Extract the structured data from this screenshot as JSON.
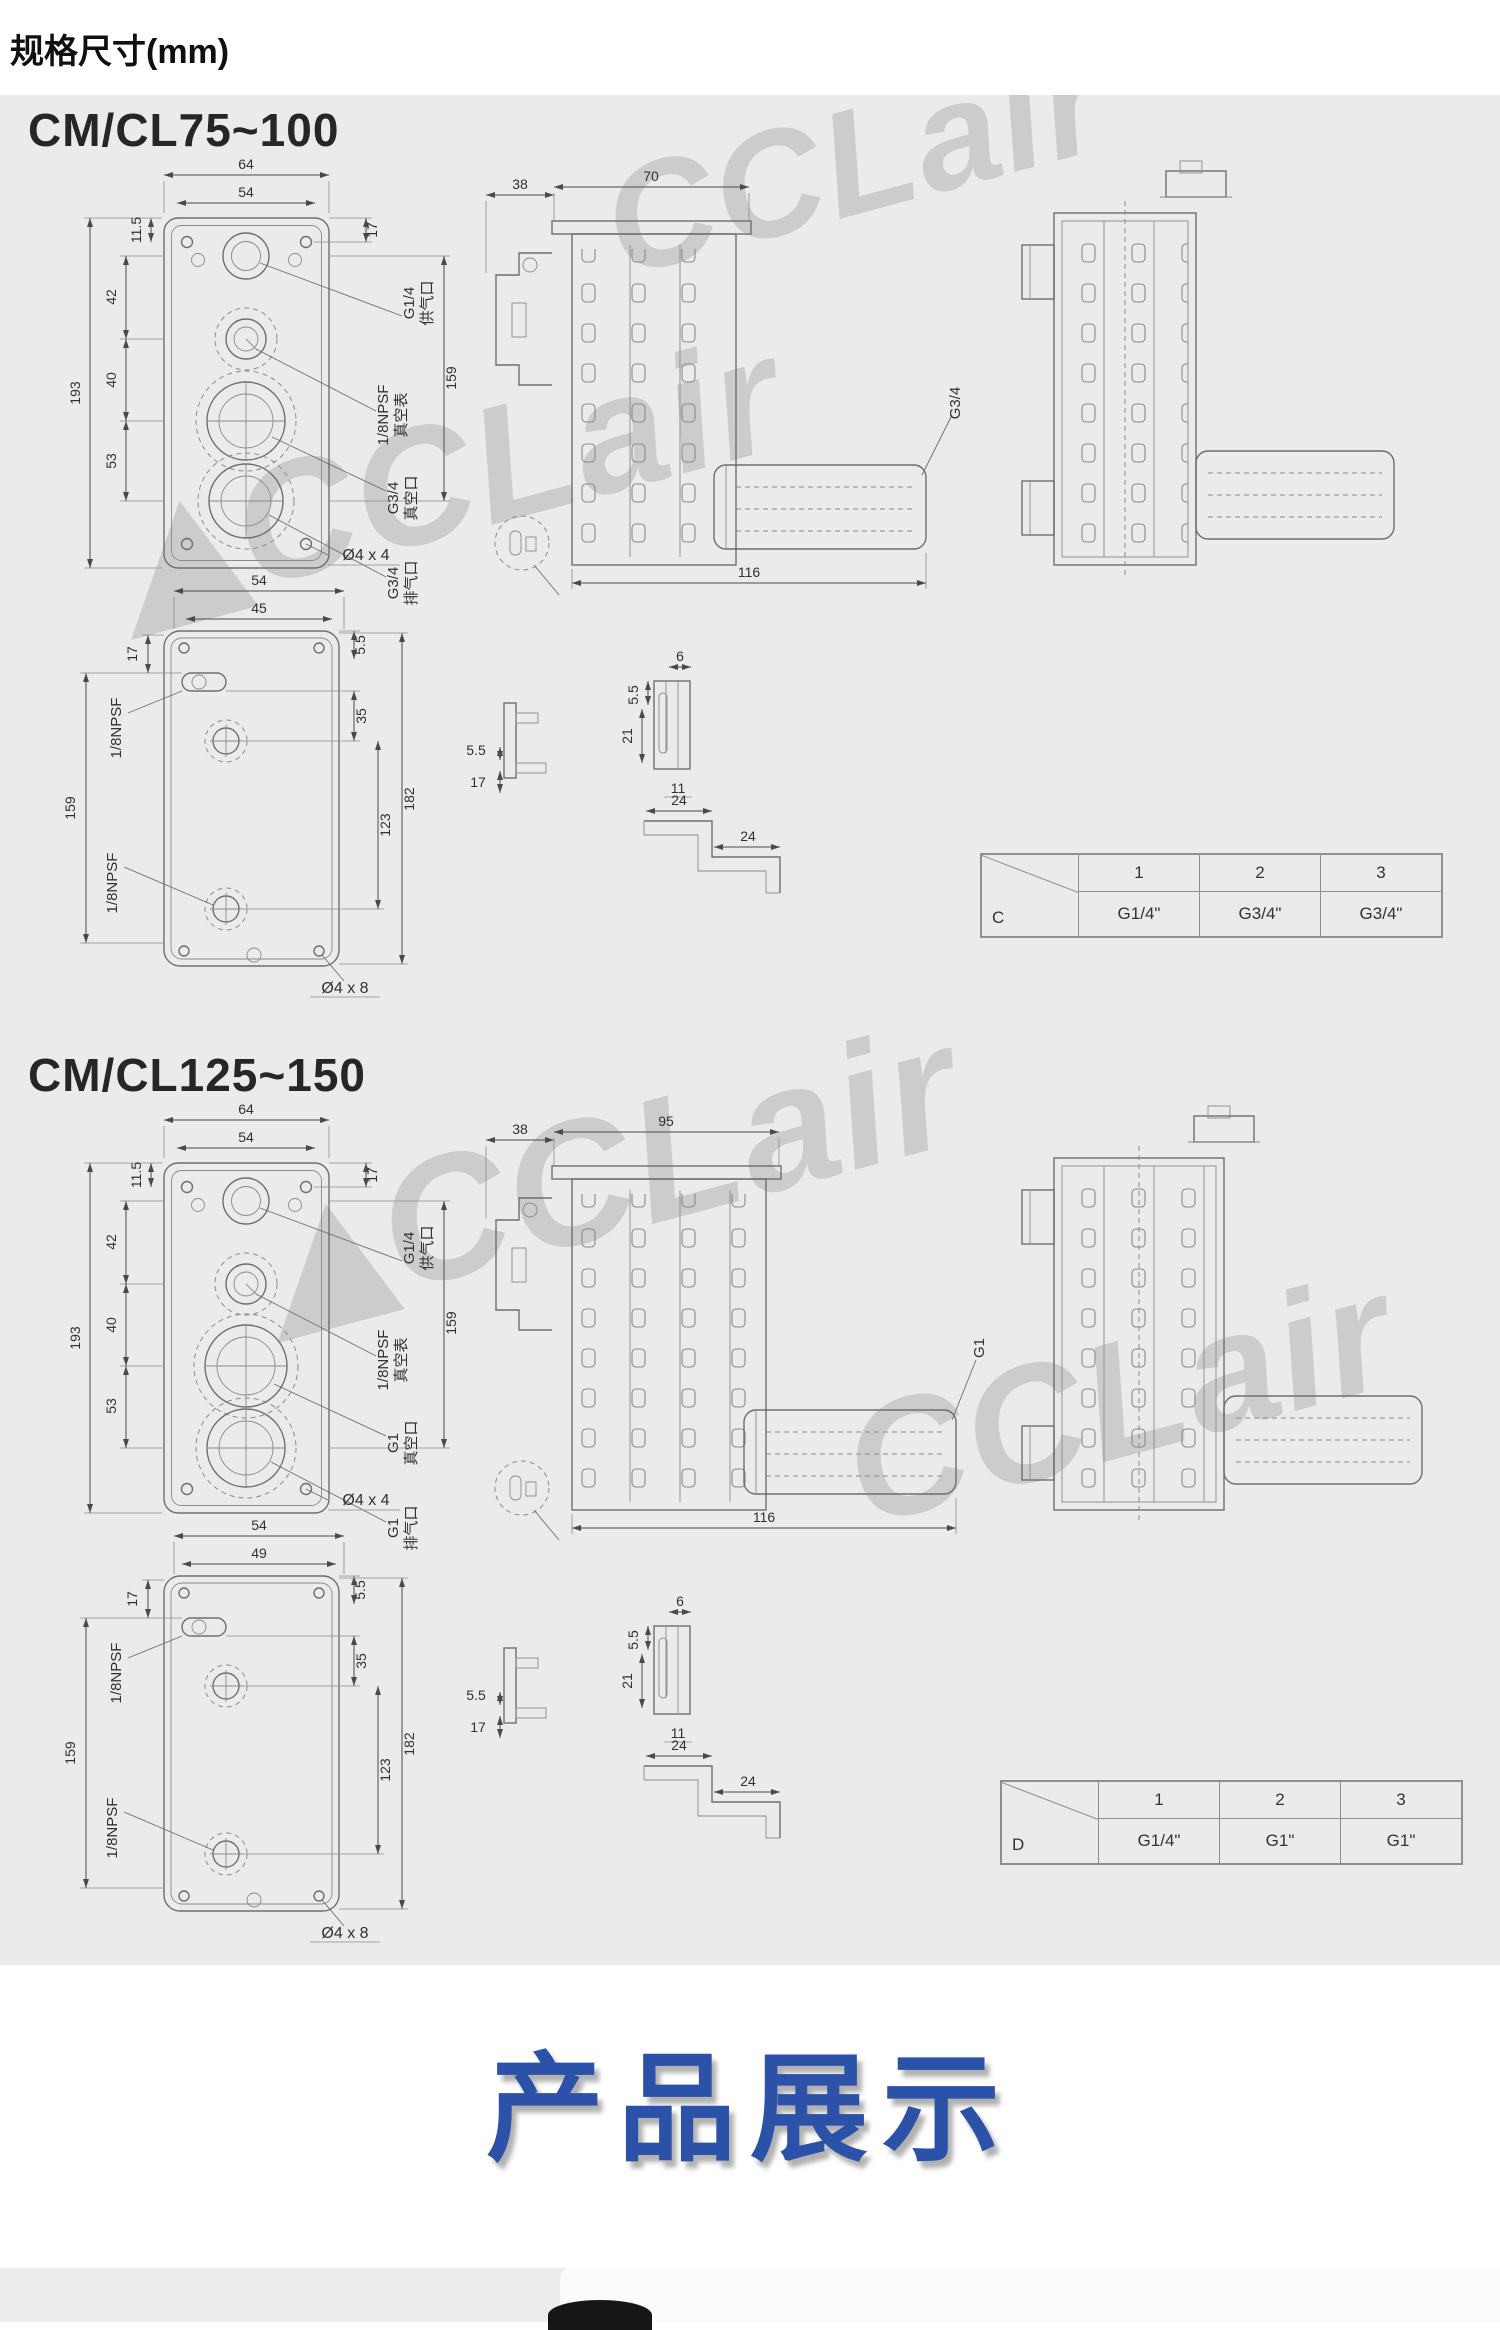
{
  "page": {
    "title": "规格尺寸(mm)",
    "watermark": "CCLair",
    "showcase_title": "产品展示",
    "colors": {
      "accent_blue": "#2b51a8",
      "panel_bg": "#ebebeb",
      "line_gray": "#6e6e6e"
    }
  },
  "sections": [
    {
      "heading": "CM/CL75~100",
      "front": {
        "dim_outer_width": "64",
        "dim_inner_width": "54",
        "dim_top_offset": "11.5",
        "dim_seg1": "42",
        "dim_seg2": "40",
        "dim_seg3": "53",
        "dim_height": "193",
        "dim_right_top": "17",
        "dim_right_span": "159",
        "supply_spec": "G1/4",
        "supply_name": "供气口",
        "gauge_spec": "1/8NPSF",
        "gauge_name": "真空表",
        "vacuum_spec": "G3/4",
        "vacuum_name": "真空口",
        "exhaust_spec": "G3/4",
        "exhaust_name": "排气口",
        "holes_label": "Ø4 x 4"
      },
      "side": {
        "dim_left": "38",
        "dim_body": "70",
        "dim_bottom": "116",
        "port_label": "G3/4"
      },
      "bottom": {
        "dim_outer_width": "54",
        "dim_inner_width": "45",
        "dim_top_left": "17",
        "dim_left_span": "159",
        "dim_right_small": "5.5",
        "dim_right_seg": "35",
        "dim_right_span1": "123",
        "dim_right_span2": "182",
        "port_top_label": "1/8NPSF",
        "port_bottom_label": "1/8NPSF",
        "holes_label": "Ø4 x 8"
      },
      "details": {
        "dim_a1": "5.5",
        "dim_a2": "17",
        "dim_b1": "5.5",
        "dim_b2": "6",
        "dim_b3": "21",
        "dim_b4": "11",
        "dim_c1": "24",
        "dim_c2": "24"
      },
      "table": {
        "corner": "C",
        "cols": [
          "1",
          "2",
          "3"
        ],
        "values": [
          "G1/4\"",
          "G3/4\"",
          "G3/4\""
        ]
      }
    },
    {
      "heading": "CM/CL125~150",
      "front": {
        "dim_outer_width": "64",
        "dim_inner_width": "54",
        "dim_top_offset": "11.5",
        "dim_seg1": "42",
        "dim_seg2": "40",
        "dim_seg3": "53",
        "dim_height": "193",
        "dim_right_top": "17",
        "dim_right_span": "159",
        "supply_spec": "G1/4",
        "supply_name": "供气口",
        "gauge_spec": "1/8NPSF",
        "gauge_name": "真空表",
        "vacuum_spec": "G1",
        "vacuum_name": "真空口",
        "exhaust_spec": "G1",
        "exhaust_name": "排气口",
        "holes_label": "Ø4 x 4"
      },
      "side": {
        "dim_left": "38",
        "dim_body": "95",
        "dim_bottom": "116",
        "port_label": "G1"
      },
      "bottom": {
        "dim_outer_width": "54",
        "dim_inner_width": "49",
        "dim_top_left": "17",
        "dim_left_span": "159",
        "dim_right_small": "5.5",
        "dim_right_seg": "35",
        "dim_right_span1": "123",
        "dim_right_span2": "182",
        "port_top_label": "1/8NPSF",
        "port_bottom_label": "1/8NPSF",
        "holes_label": "Ø4 x 8"
      },
      "details": {
        "dim_a1": "5.5",
        "dim_a2": "17",
        "dim_b1": "5.5",
        "dim_b2": "6",
        "dim_b3": "21",
        "dim_b4": "11",
        "dim_c1": "24",
        "dim_c2": "24"
      },
      "table": {
        "corner": "D",
        "cols": [
          "1",
          "2",
          "3"
        ],
        "values": [
          "G1/4\"",
          "G1\"",
          "G1\""
        ]
      }
    }
  ]
}
